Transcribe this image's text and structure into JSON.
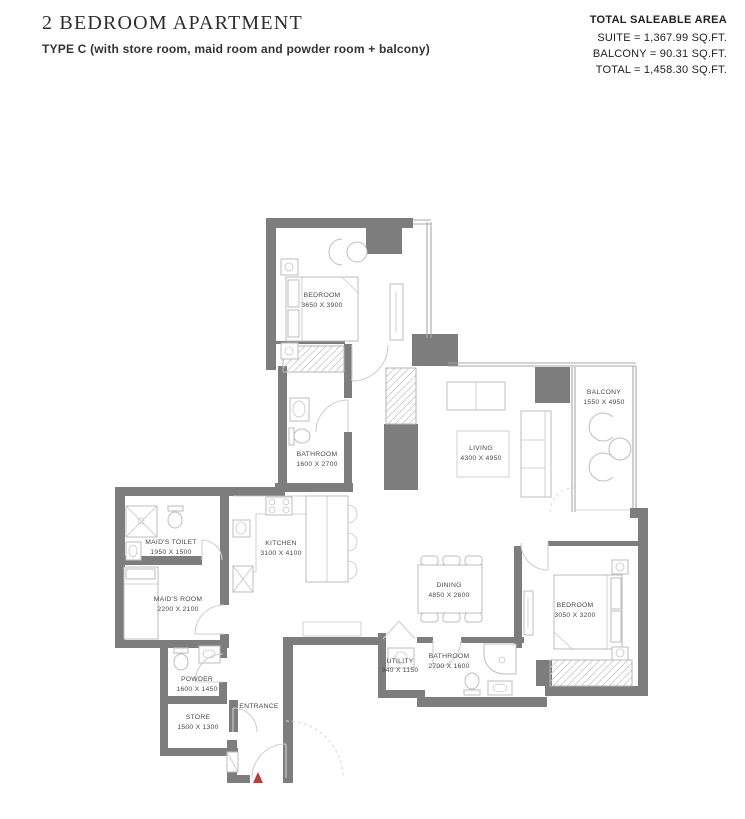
{
  "header": {
    "title": "2 BEDROOM APARTMENT",
    "subtitle": "TYPE C (with store room, maid room and powder room + balcony)"
  },
  "area_summary": {
    "heading": "TOTAL SALEABLE AREA",
    "suite": "SUITE = 1,367.99 SQ.FT.",
    "balcony": "BALCONY = 90.31 SQ.FT.",
    "total": "TOTAL = 1,458.30 SQ.FT."
  },
  "floorplan": {
    "rooms": [
      {
        "id": "bedroom-1",
        "label": "BEDROOM",
        "dims": "3650 X 3900"
      },
      {
        "id": "bathroom-1",
        "label": "BATHROOM",
        "dims": "1600 X 2700"
      },
      {
        "id": "living",
        "label": "LIVING",
        "dims": "4300 X 4950"
      },
      {
        "id": "balcony",
        "label": "BALCONY",
        "dims": "1550 X 4950"
      },
      {
        "id": "kitchen",
        "label": "KITCHEN",
        "dims": "3100 X 4100"
      },
      {
        "id": "maids-toilet",
        "label": "MAID'S TOILET",
        "dims": "1950 X 1500"
      },
      {
        "id": "maids-room",
        "label": "MAID'S ROOM",
        "dims": "2200 X 2100"
      },
      {
        "id": "dining",
        "label": "DINING",
        "dims": "4850 X 2600"
      },
      {
        "id": "bedroom-2",
        "label": "BEDROOM",
        "dims": "3050 X 3200"
      },
      {
        "id": "bathroom-2",
        "label": "BATHROOM",
        "dims": "2700 X 1600"
      },
      {
        "id": "utility",
        "label": "UTILITY",
        "dims": "940 X 1150"
      },
      {
        "id": "powder",
        "label": "POWDER",
        "dims": "1600 X 1450"
      },
      {
        "id": "store",
        "label": "STORE",
        "dims": "1500 X 1300"
      },
      {
        "id": "entrance",
        "label": "ENTRANCE",
        "dims": ""
      }
    ],
    "colors": {
      "wall": "#7d7d7d",
      "furniture": "#bdbdbd",
      "door_arc": "#cfcfcf",
      "room_label": "#4a4a4a",
      "entrance_marker": "#bf3a3a"
    }
  }
}
